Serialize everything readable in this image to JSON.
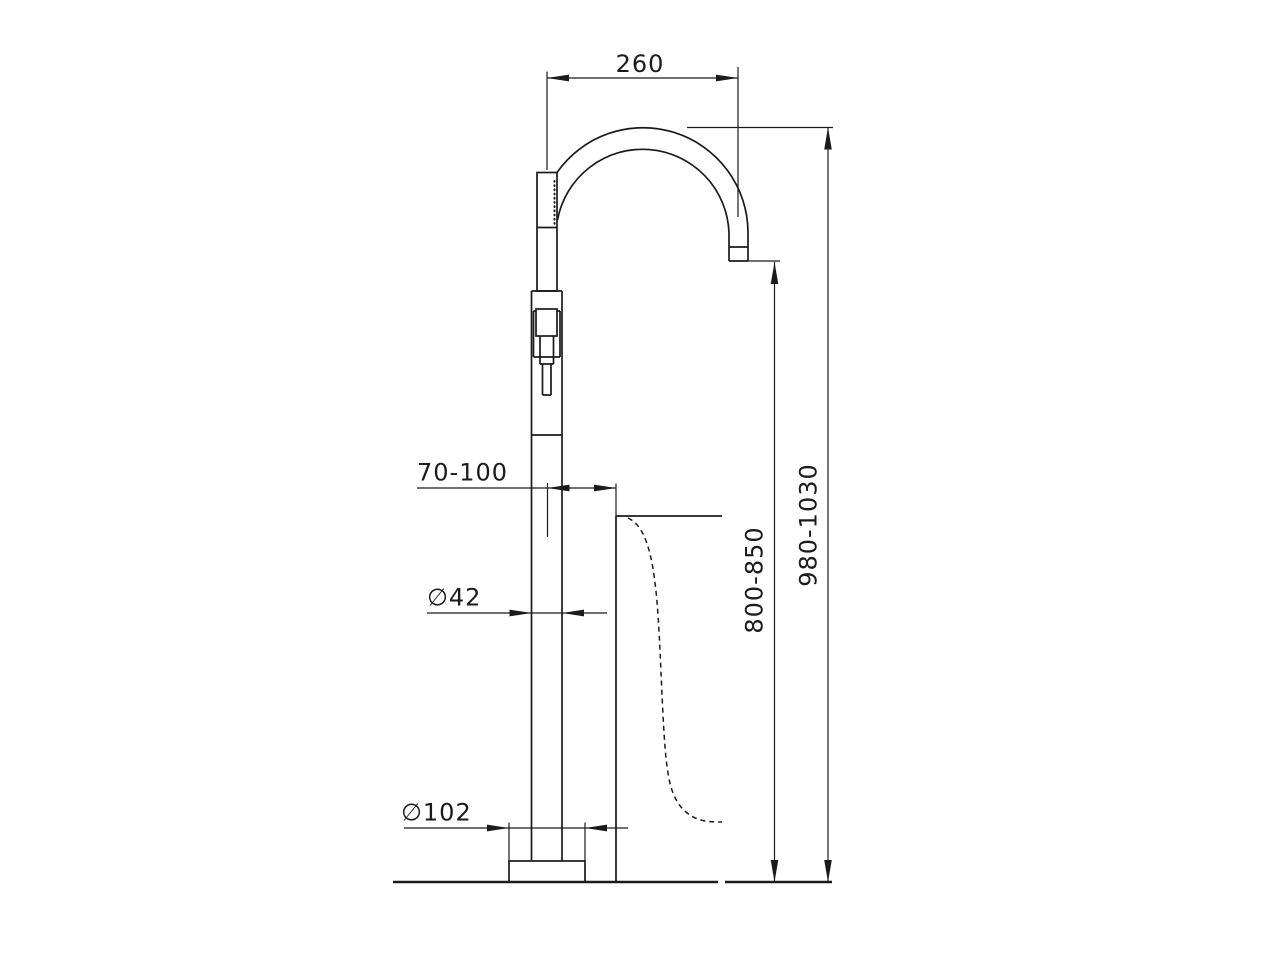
{
  "diagram": {
    "kind": "technical-dimension-drawing",
    "subject": "freestanding-floor-mounted-bath-mixer-with-gooseneck-spout-and-handshower",
    "colors": {
      "line": "#1b1b1b",
      "background": "#ffffff"
    },
    "dimensions": {
      "spout_reach": {
        "label": "260"
      },
      "centre_to_tub_rim": {
        "label": "70-100"
      },
      "column_diameter": {
        "label": "∅42"
      },
      "base_diameter": {
        "label": "∅102"
      },
      "spout_outlet_height": {
        "label": "800-850"
      },
      "overall_height": {
        "label": "980-1030"
      }
    }
  }
}
